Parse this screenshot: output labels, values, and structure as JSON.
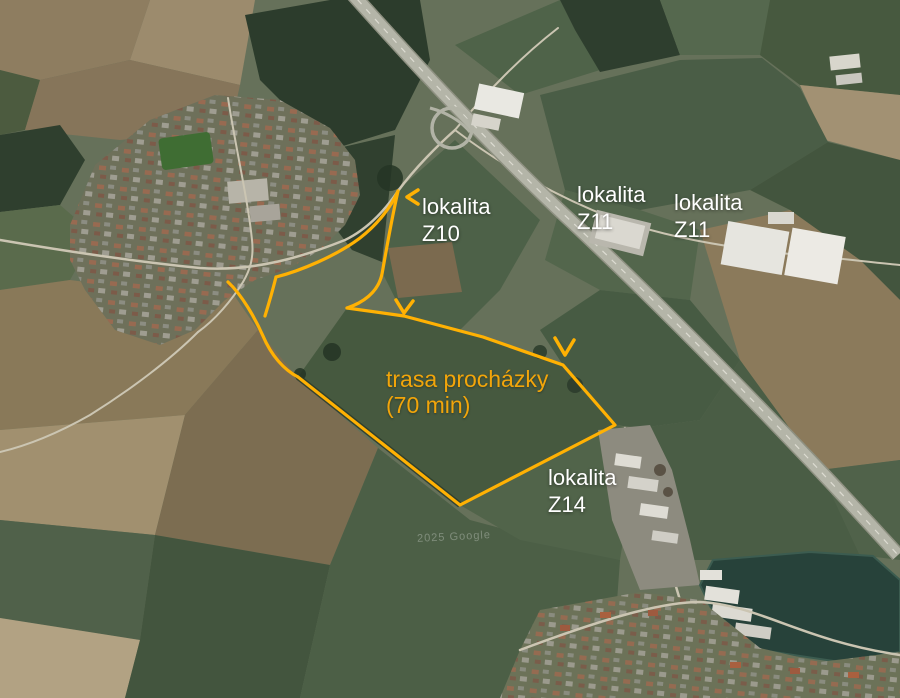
{
  "map": {
    "watermark": "2025 Google",
    "colors": {
      "route_line": "#FFB103",
      "route_text": "#F2A50A",
      "label_text": "#FFFFFF"
    }
  },
  "labels": {
    "z10": {
      "line1": "lokalita",
      "line2": "Z10"
    },
    "z11_west": {
      "line1": "lokalita",
      "line2": "Z11"
    },
    "z11_east": {
      "line1": "lokalita",
      "line2": "Z11"
    },
    "z14": {
      "line1": "lokalita",
      "line2": "Z14"
    },
    "route_caption": {
      "line1": "trasa procházky",
      "line2": "(70 min)"
    }
  },
  "route": {
    "segments": {
      "outbound_curve": "M276,277 C300,271 336,256 360,238 C378,224 391,207 398,191",
      "z10_descent": "M398,191 C391,222 386,252 382,274 C378,293 362,303 347,308",
      "field_loop": "M347,308 L404,316 L483,337 L563,365 L615,425 L460,505 L298,377",
      "return_curve": "M298,377 C284,370 271,355 263,336 C255,318 242,295 228,282",
      "start_spur": "M276,277 C273,289 269,303 265,316"
    },
    "arrows": {
      "z10_chevron": "M418,190 L407,197 L418,204",
      "mid_chevron": "M396,300 L404,313 L413,301",
      "east_chevron": "M555,338 L565,355 L574,340"
    }
  }
}
